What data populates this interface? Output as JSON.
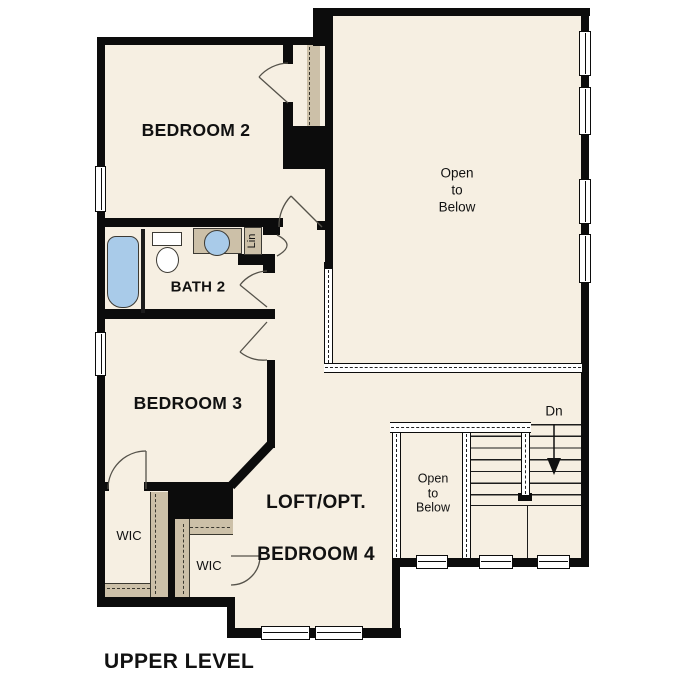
{
  "title": "UPPER LEVEL",
  "rooms": {
    "bedroom2": {
      "label": "BEDROOM 2"
    },
    "bath2": {
      "label": "BATH 2"
    },
    "bedroom3": {
      "label": "BEDROOM 3"
    },
    "loft": {
      "label_line1": "LOFT/OPT.",
      "label_line2": "BEDROOM 4"
    },
    "wic1": {
      "label": "WIC"
    },
    "wic2": {
      "label": "WIC"
    },
    "linen": {
      "label": "Lin"
    },
    "open_to_below_main": {
      "label": "Open\nto\nBelow"
    },
    "open_to_below_stair": {
      "label": "Open\nto\nBelow"
    },
    "stairs": {
      "direction_label": "Dn"
    }
  },
  "colors": {
    "background": "#ffffff",
    "floor": "#f6efe2",
    "closet_shelf": "#ccc0a8",
    "wall": "#0c0c0c",
    "fixture": "#a9cbe9",
    "door_stroke": "#55524a"
  }
}
